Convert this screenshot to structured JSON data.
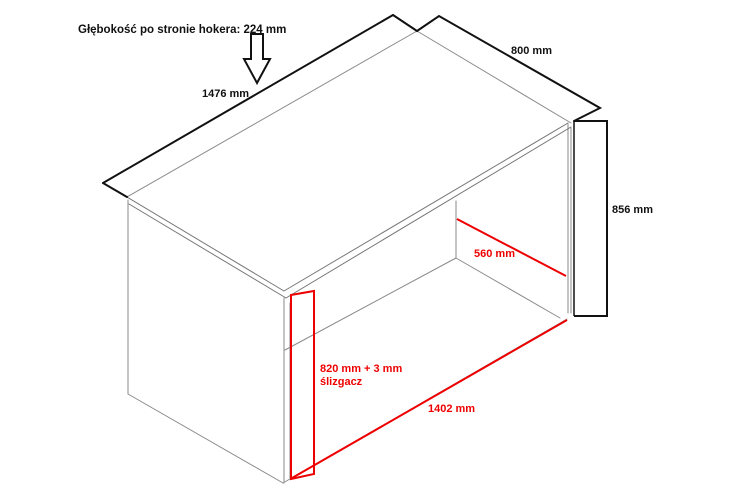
{
  "diagram": {
    "title": "Głębokość po stronie hokera: 224 mm",
    "dimensions": {
      "top_length": "1476 mm",
      "top_depth": "800 mm",
      "side_height": "856 mm",
      "inner_depth": "560 mm",
      "inner_height_line1": "820 mm + 3 mm",
      "inner_height_line2": "ślizgacz",
      "inner_width": "1402 mm"
    },
    "colors": {
      "outline": "#111111",
      "secondary_lines": "#8a8a8a",
      "front_edges": "#777777",
      "highlight": "#ee0000",
      "background": "#ffffff"
    }
  }
}
